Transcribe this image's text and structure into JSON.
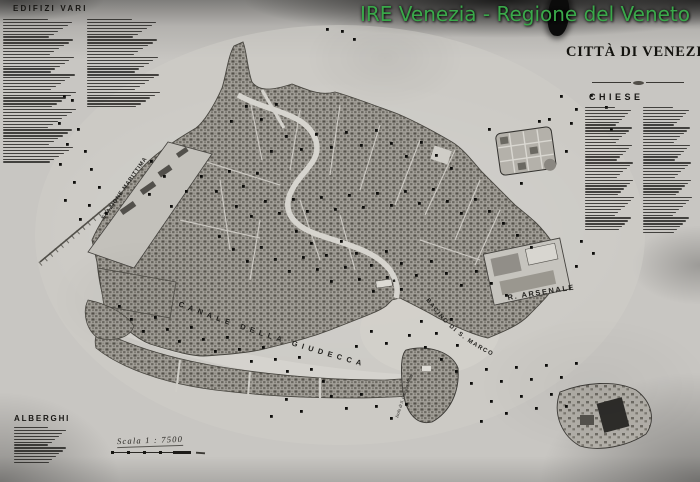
{
  "overlay": {
    "text": "IRE Venezia - Regione del Veneto",
    "color": "#3aa94a"
  },
  "map": {
    "title": "CITTÀ DI VENEZIA",
    "scale_label": "Scala 1 : 7500",
    "labels": {
      "canale_giudecca": "CANALE DELLA GIUDECCA",
      "bacino_s_marco": "BACINO DI S. MARCO",
      "arsenale": "R. ARSENALE",
      "stazione_marittima": "STAZIONE MARITTIMA",
      "isola_s_giorgio": "Isola di S. Giorgio Magg."
    },
    "markers": [
      [
        63,
        95
      ],
      [
        71,
        99
      ],
      [
        58,
        122
      ],
      [
        77,
        128
      ],
      [
        66,
        143
      ],
      [
        84,
        150
      ],
      [
        59,
        163
      ],
      [
        90,
        168
      ],
      [
        73,
        181
      ],
      [
        98,
        186
      ],
      [
        64,
        199
      ],
      [
        88,
        204
      ],
      [
        105,
        212
      ],
      [
        79,
        218
      ],
      [
        326,
        28
      ],
      [
        341,
        30
      ],
      [
        353,
        38
      ],
      [
        150,
        160
      ],
      [
        163,
        175
      ],
      [
        148,
        193
      ],
      [
        170,
        205
      ],
      [
        185,
        190
      ],
      [
        200,
        175
      ],
      [
        215,
        190
      ],
      [
        228,
        170
      ],
      [
        242,
        185
      ],
      [
        256,
        172
      ],
      [
        235,
        205
      ],
      [
        250,
        215
      ],
      [
        264,
        200
      ],
      [
        278,
        212
      ],
      [
        292,
        198
      ],
      [
        306,
        210
      ],
      [
        320,
        196
      ],
      [
        334,
        208
      ],
      [
        348,
        194
      ],
      [
        362,
        206
      ],
      [
        376,
        192
      ],
      [
        390,
        204
      ],
      [
        404,
        190
      ],
      [
        418,
        202
      ],
      [
        432,
        188
      ],
      [
        446,
        200
      ],
      [
        460,
        212
      ],
      [
        474,
        198
      ],
      [
        488,
        210
      ],
      [
        502,
        222
      ],
      [
        516,
        234
      ],
      [
        530,
        246
      ],
      [
        295,
        230
      ],
      [
        310,
        242
      ],
      [
        325,
        254
      ],
      [
        340,
        240
      ],
      [
        355,
        252
      ],
      [
        370,
        264
      ],
      [
        385,
        250
      ],
      [
        400,
        262
      ],
      [
        415,
        274
      ],
      [
        430,
        260
      ],
      [
        445,
        272
      ],
      [
        460,
        284
      ],
      [
        475,
        270
      ],
      [
        490,
        282
      ],
      [
        505,
        294
      ],
      [
        270,
        150
      ],
      [
        285,
        135
      ],
      [
        300,
        148
      ],
      [
        315,
        133
      ],
      [
        330,
        146
      ],
      [
        345,
        131
      ],
      [
        360,
        144
      ],
      [
        375,
        129
      ],
      [
        390,
        142
      ],
      [
        405,
        155
      ],
      [
        420,
        141
      ],
      [
        435,
        154
      ],
      [
        450,
        167
      ],
      [
        230,
        120
      ],
      [
        245,
        105
      ],
      [
        260,
        118
      ],
      [
        275,
        103
      ],
      [
        218,
        235
      ],
      [
        232,
        248
      ],
      [
        246,
        260
      ],
      [
        260,
        246
      ],
      [
        274,
        258
      ],
      [
        288,
        270
      ],
      [
        302,
        256
      ],
      [
        316,
        268
      ],
      [
        330,
        280
      ],
      [
        344,
        266
      ],
      [
        358,
        278
      ],
      [
        372,
        290
      ],
      [
        386,
        276
      ],
      [
        400,
        288
      ],
      [
        118,
        305
      ],
      [
        130,
        318
      ],
      [
        142,
        330
      ],
      [
        154,
        316
      ],
      [
        166,
        328
      ],
      [
        178,
        340
      ],
      [
        190,
        326
      ],
      [
        202,
        338
      ],
      [
        214,
        350
      ],
      [
        226,
        336
      ],
      [
        238,
        348
      ],
      [
        250,
        360
      ],
      [
        262,
        346
      ],
      [
        274,
        358
      ],
      [
        286,
        370
      ],
      [
        298,
        356
      ],
      [
        310,
        368
      ],
      [
        322,
        380
      ],
      [
        455,
        370
      ],
      [
        470,
        382
      ],
      [
        485,
        368
      ],
      [
        500,
        380
      ],
      [
        515,
        366
      ],
      [
        530,
        378
      ],
      [
        545,
        364
      ],
      [
        560,
        376
      ],
      [
        575,
        362
      ],
      [
        520,
        395
      ],
      [
        535,
        407
      ],
      [
        550,
        393
      ],
      [
        565,
        405
      ],
      [
        490,
        400
      ],
      [
        505,
        412
      ],
      [
        480,
        420
      ],
      [
        560,
        95
      ],
      [
        575,
        108
      ],
      [
        590,
        94
      ],
      [
        605,
        106
      ],
      [
        570,
        122
      ],
      [
        548,
        118
      ],
      [
        610,
        128
      ],
      [
        488,
        128
      ],
      [
        538,
        120
      ],
      [
        565,
        150
      ],
      [
        520,
        182
      ],
      [
        580,
        240
      ],
      [
        592,
        252
      ],
      [
        575,
        265
      ],
      [
        420,
        320
      ],
      [
        435,
        332
      ],
      [
        450,
        318
      ],
      [
        408,
        334
      ],
      [
        424,
        346
      ],
      [
        440,
        358
      ],
      [
        456,
        344
      ],
      [
        370,
        330
      ],
      [
        385,
        342
      ],
      [
        355,
        345
      ],
      [
        330,
        395
      ],
      [
        345,
        407
      ],
      [
        360,
        393
      ],
      [
        375,
        405
      ],
      [
        390,
        417
      ],
      [
        405,
        403
      ],
      [
        300,
        410
      ],
      [
        285,
        398
      ],
      [
        270,
        415
      ]
    ]
  },
  "legends": {
    "edifizi_vari": {
      "title": "EDIFIZI VARI",
      "col1_lines": 50,
      "col2_lines": 31
    },
    "chiese": {
      "title": "CHIESE",
      "col1_lines": 43,
      "col2_lines": 44
    },
    "alberghi": {
      "title": "ALBERGHI",
      "col1_lines": 13
    }
  },
  "colors": {
    "paper": "#c8c6c2",
    "ink": "#1b1a17",
    "overlay_green": "#3aa94a"
  }
}
